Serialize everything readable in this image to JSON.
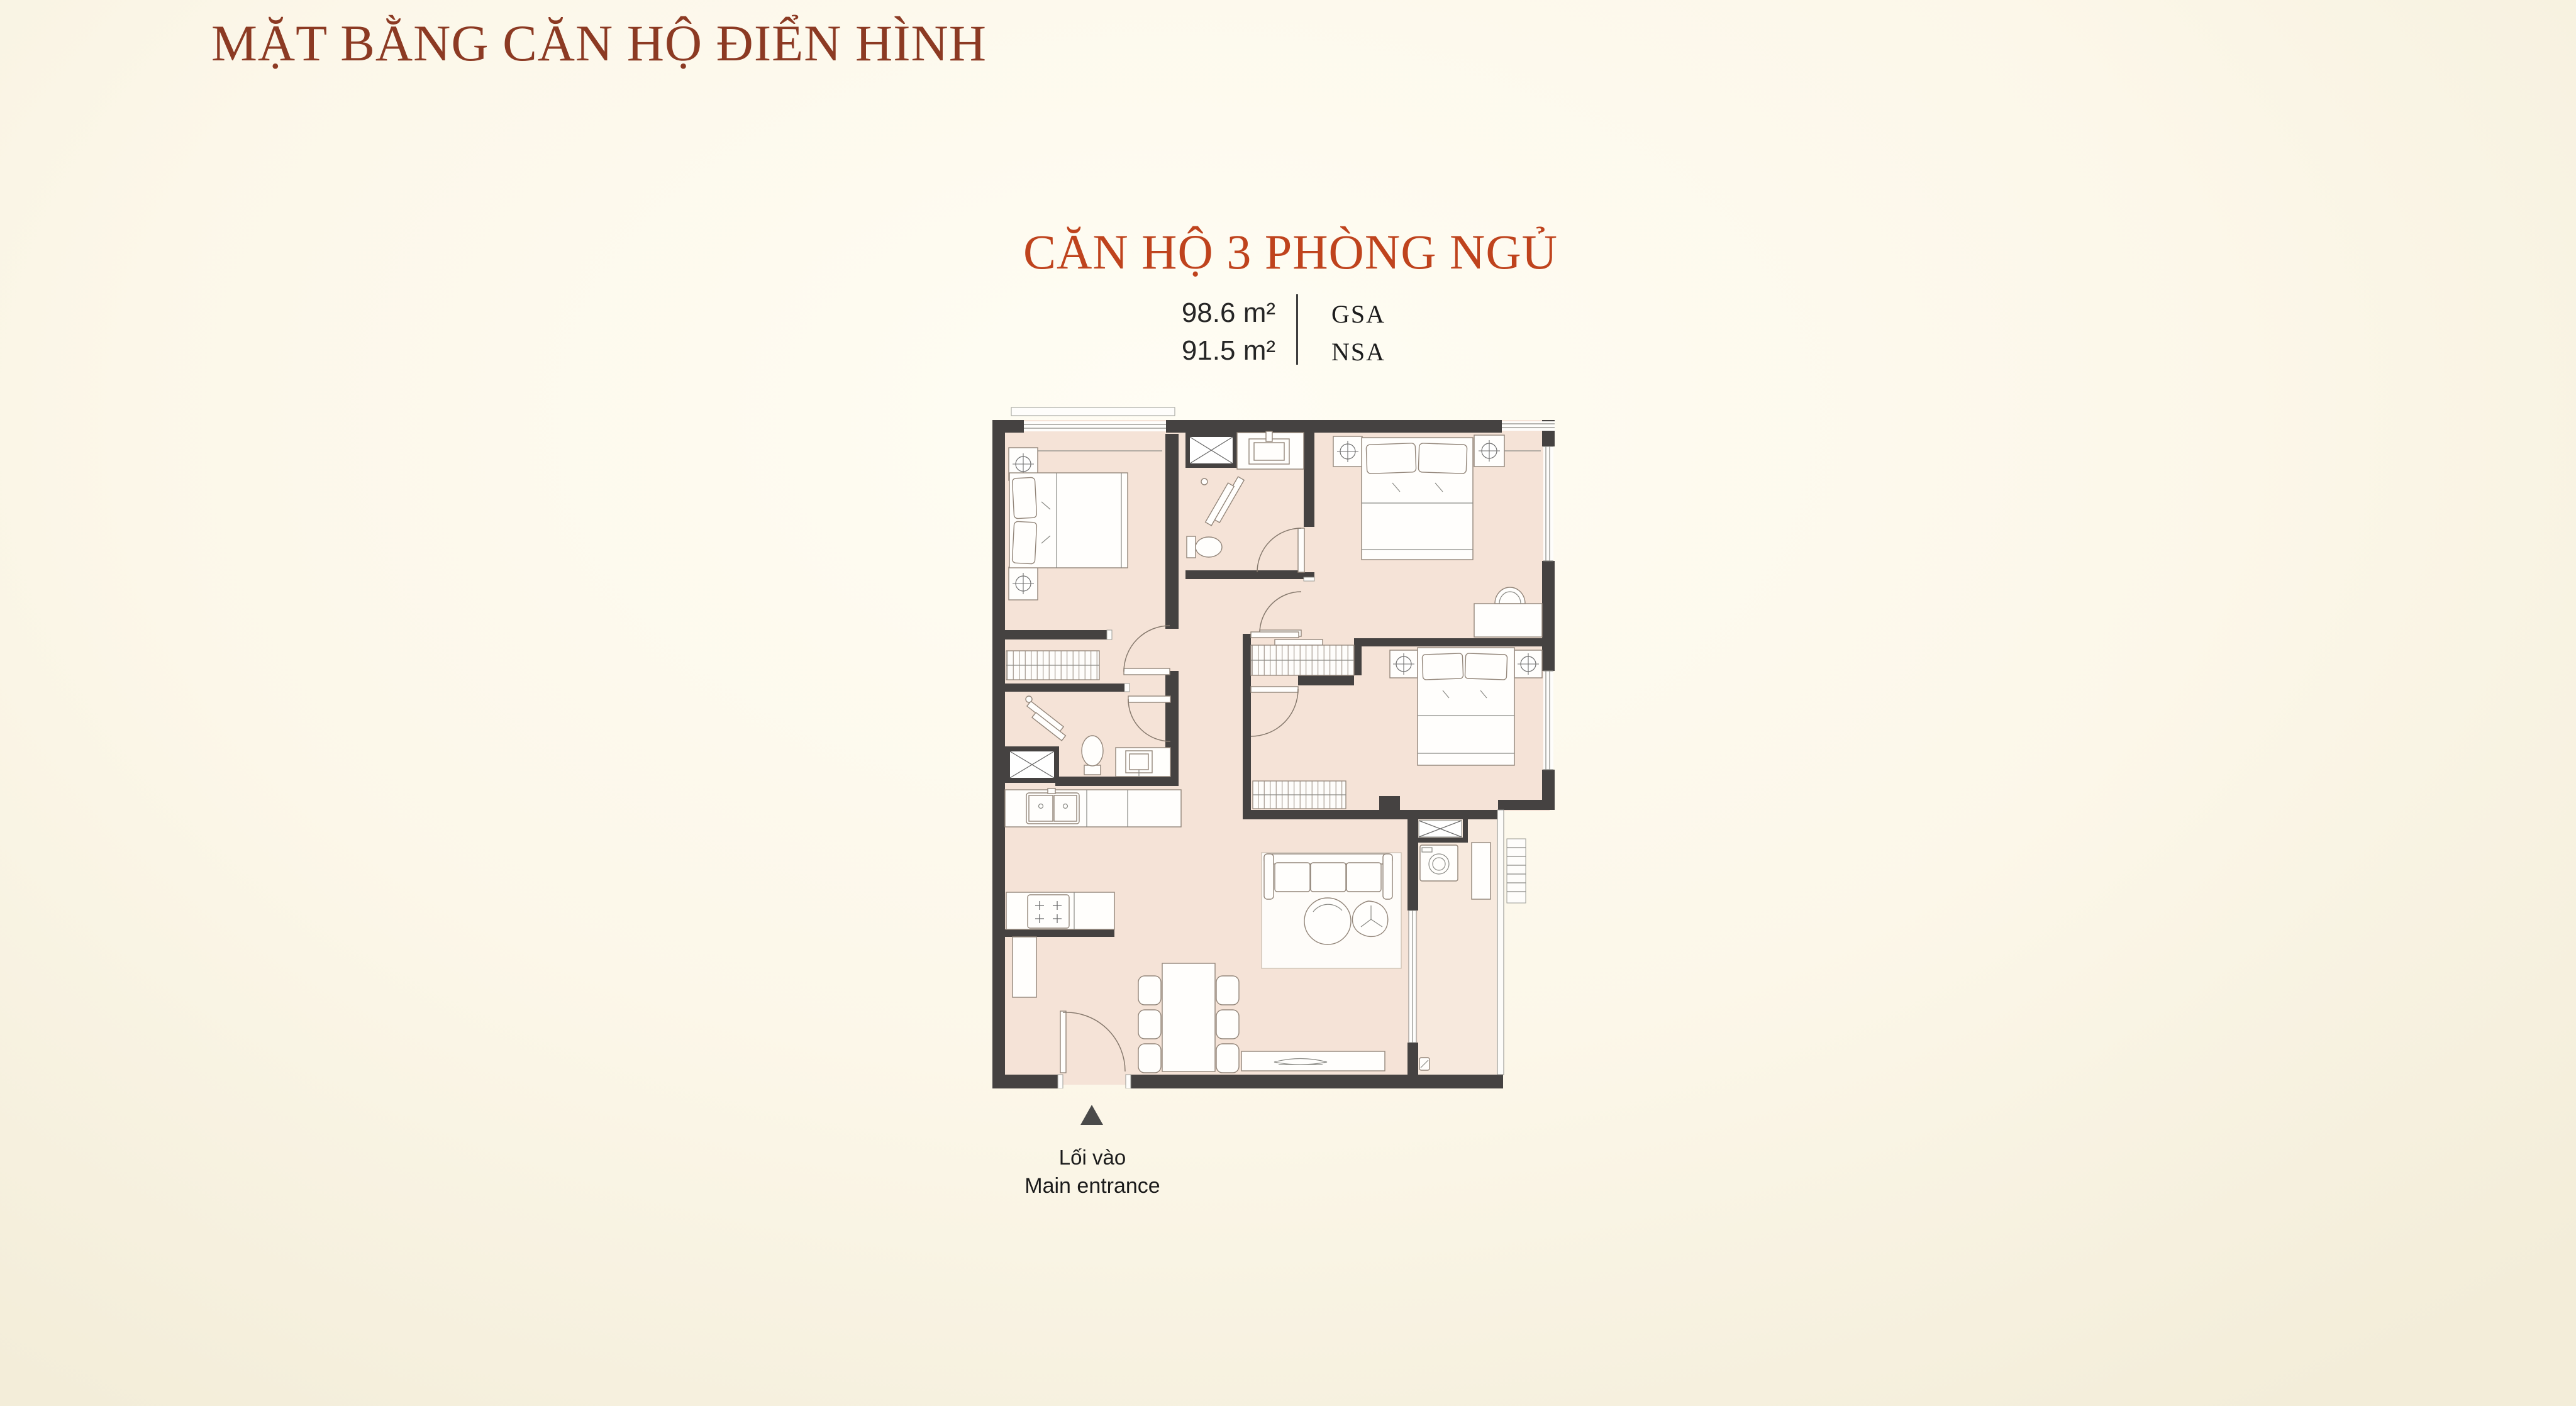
{
  "page": {
    "title": "MẶT BẰNG CĂN HỘ ĐIỂN HÌNH",
    "background_color": "#FCF7E9",
    "title_color": "#8C3A23"
  },
  "unit": {
    "name": "CĂN HỘ 3 PHÒNG NGỦ",
    "name_color": "#BF431D",
    "areas": [
      {
        "value": "98.6 m²",
        "label": "GSA"
      },
      {
        "value": "91.5 m²",
        "label": "NSA"
      }
    ]
  },
  "floor_plan": {
    "wall_color": "#454241",
    "floor_color": "#F5E3D7",
    "balcony_floor_color": "#F7E9DD",
    "furniture_outline_color": "#93867A",
    "entrance": {
      "icon": "up-triangle-icon",
      "label_vi": "Lối vào",
      "label_en": "Main entrance"
    }
  }
}
